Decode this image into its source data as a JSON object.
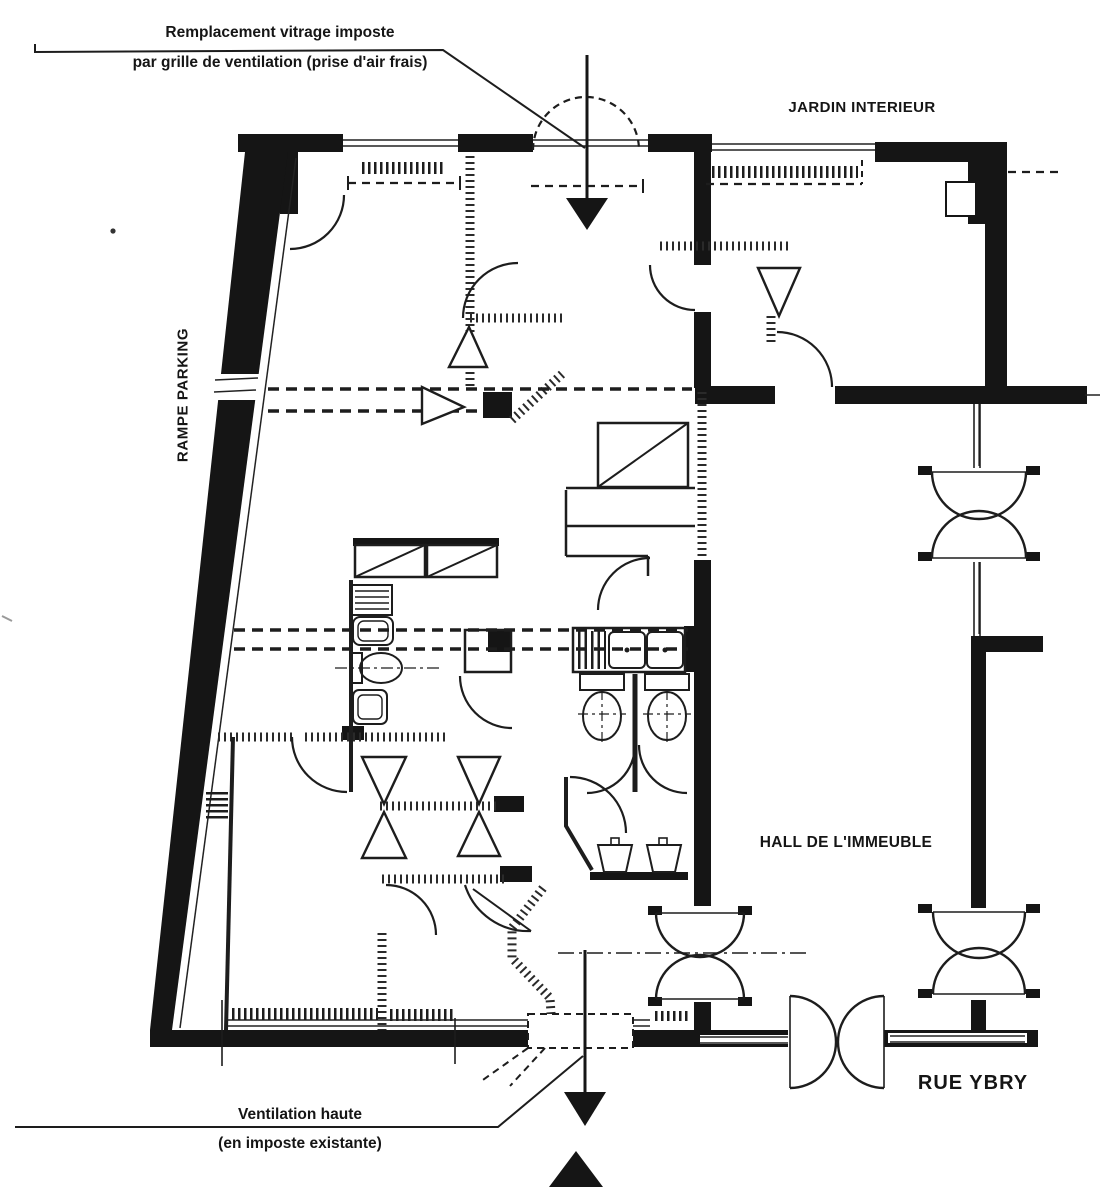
{
  "page": {
    "background": "#ffffff",
    "ink_color": "#151515"
  },
  "plan": {
    "type": "architectural-floor-plan-ventilation-scheme",
    "labels": {
      "top_annotation": {
        "line1": "Remplacement vitrage imposte",
        "line2": "par grille de ventilation (prise d'air frais)"
      },
      "jardin": "JARDIN INTERIEUR",
      "rampe_parking": "RAMPE PARKING",
      "hall": "HALL DE L'IMMEUBLE",
      "rue": "RUE YBRY",
      "bottom_annotation": {
        "line1": "Ventilation haute",
        "line2": "(en imposte existante)"
      }
    },
    "icons": {
      "airflow_arrow_top": "▼",
      "airflow_arrow_bottom": "▼",
      "north_arrow": "▲"
    }
  }
}
